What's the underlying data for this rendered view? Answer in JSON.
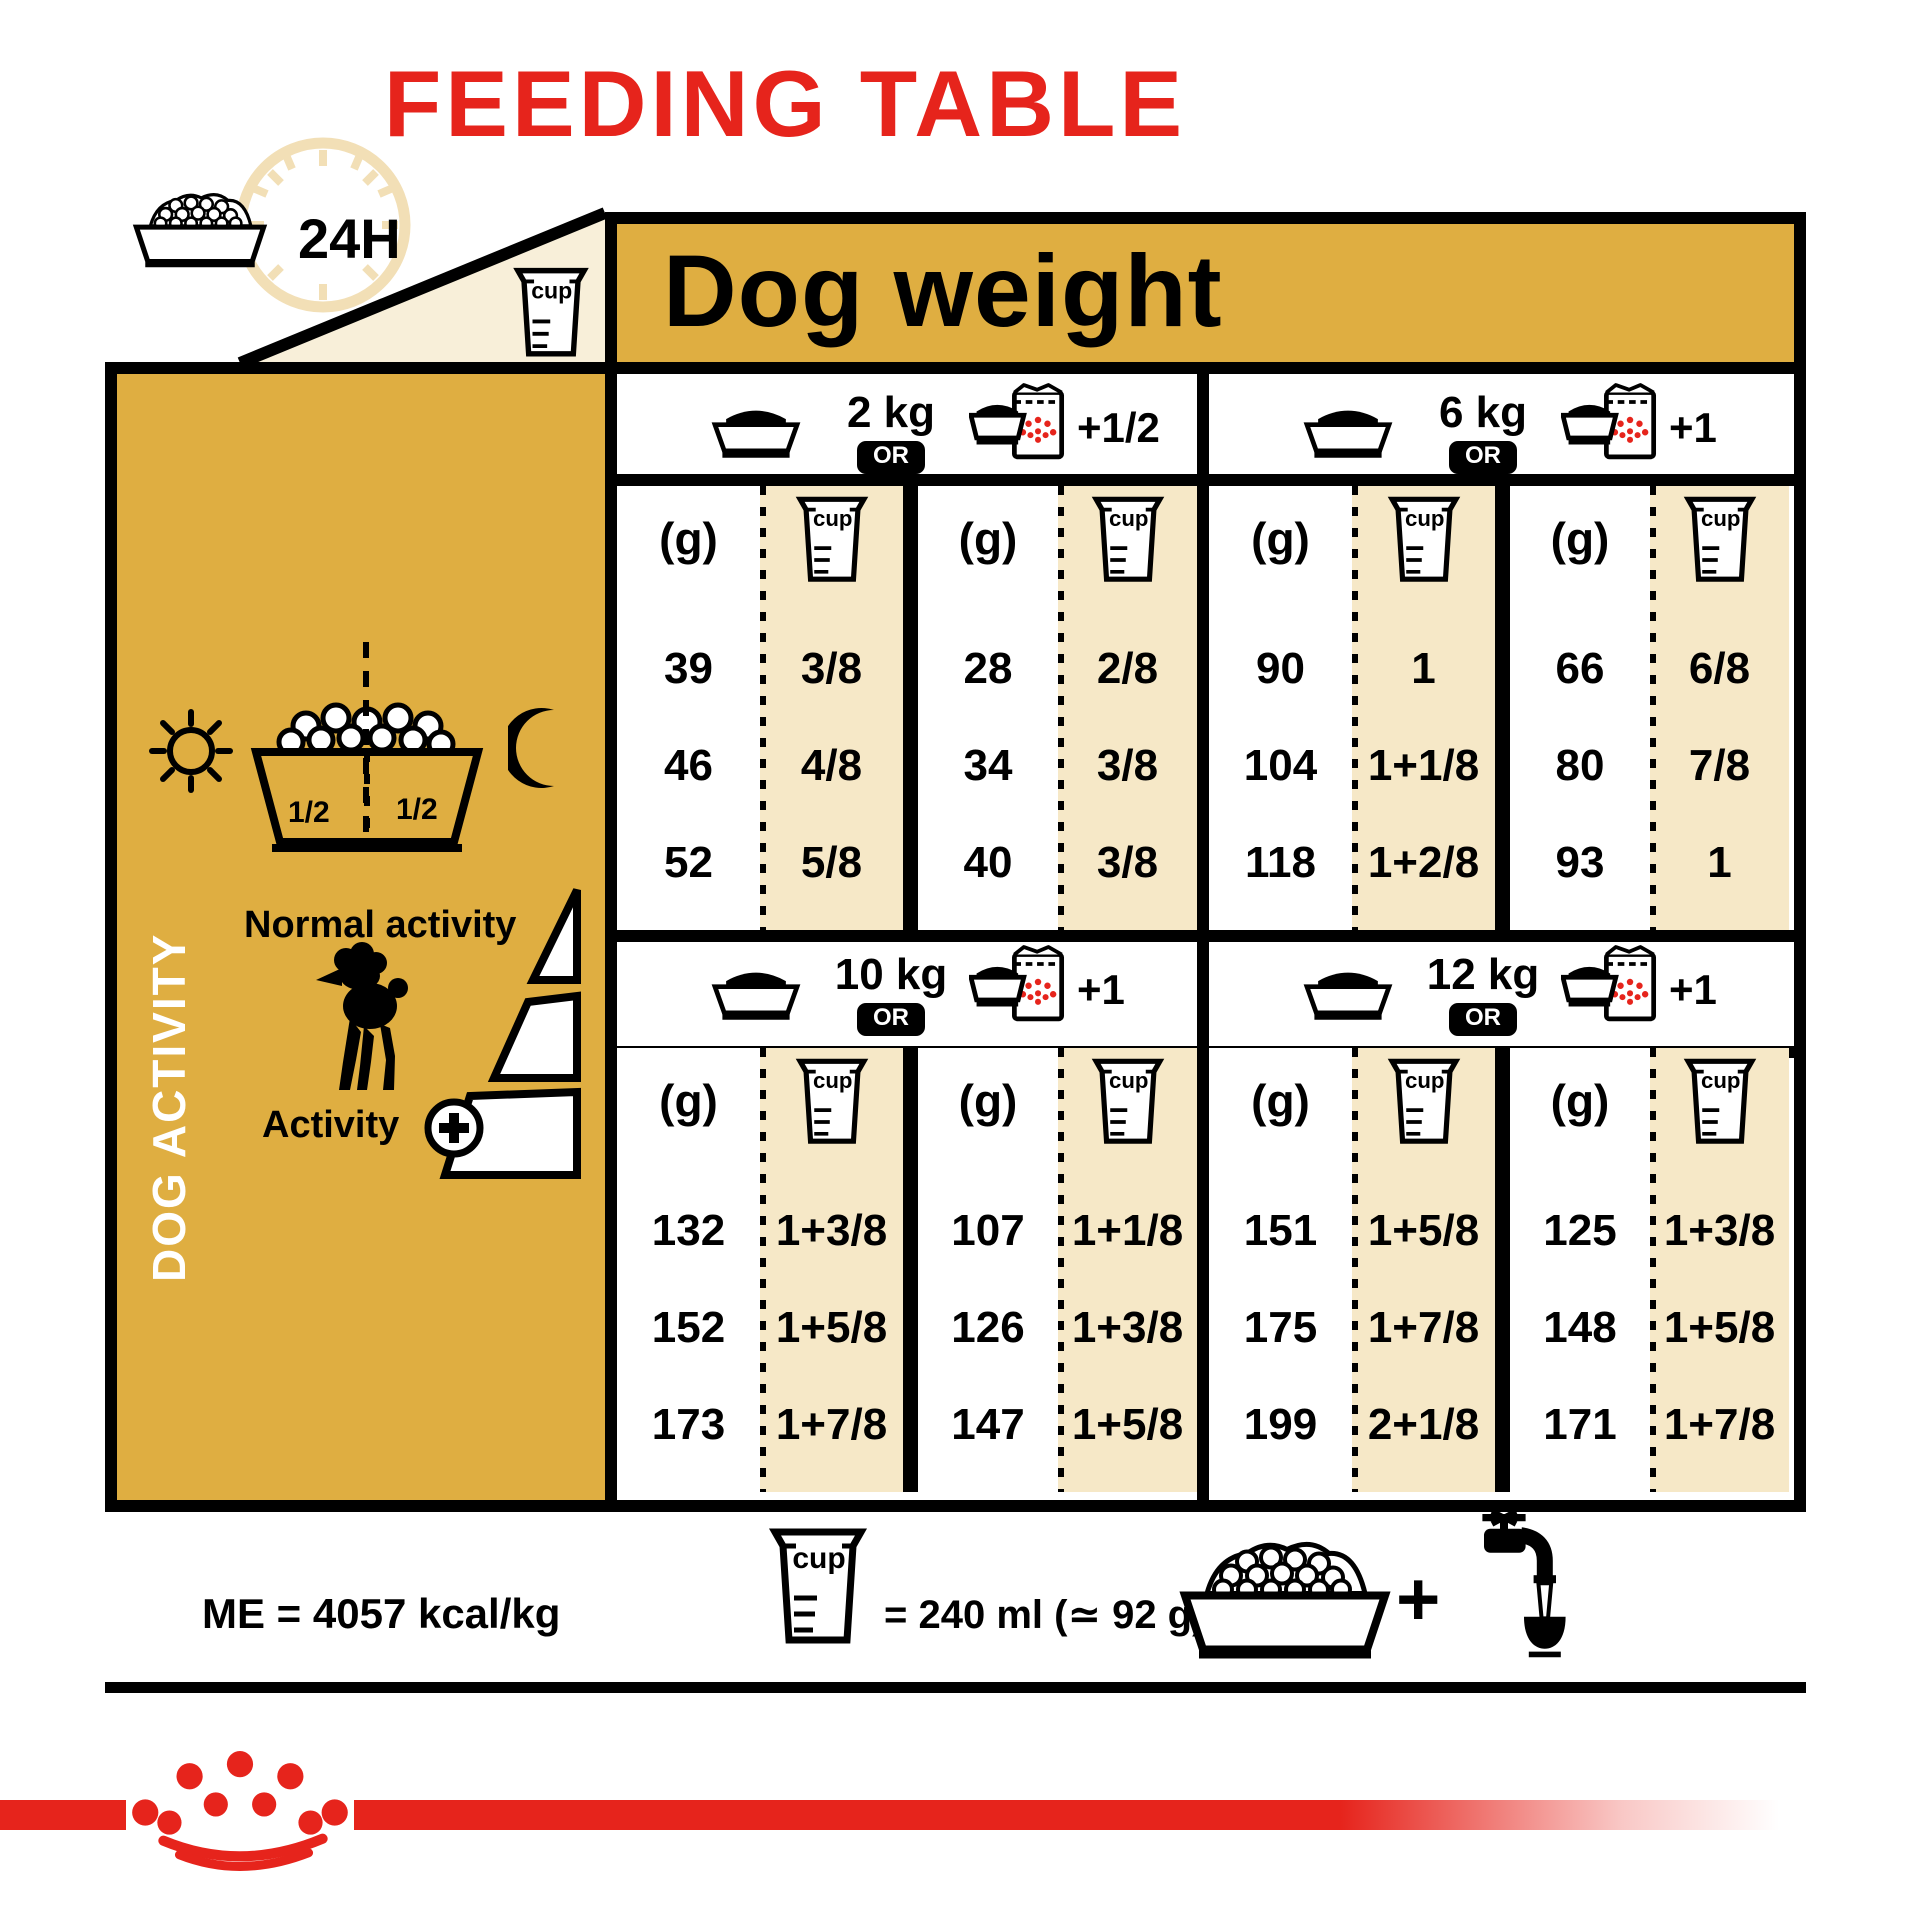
{
  "title": "FEEDING TABLE",
  "colors": {
    "gold": "#DFAE41",
    "cream_column": "#F6E8C7",
    "cream_triangle": "#F8EFD9",
    "clock_cream": "#F2DFB6",
    "red": "#E6241C",
    "black": "#000000",
    "white": "#FFFFFF"
  },
  "top": {
    "h24": "24H",
    "dog_weight": "Dog weight"
  },
  "labels": {
    "or": "OR",
    "grams": "(g)",
    "cup": "cup"
  },
  "sidebar": {
    "dog_activity": "DOG ACTIVITY",
    "half_left": "1/2",
    "half_right": "1/2",
    "normal_activity": "Normal activity",
    "activity": "Activity"
  },
  "sections": [
    {
      "weight": "2 kg",
      "extra": "+1/2",
      "rows": [
        [
          "39",
          "3/8",
          "28",
          "2/8"
        ],
        [
          "46",
          "4/8",
          "34",
          "3/8"
        ],
        [
          "52",
          "5/8",
          "40",
          "3/8"
        ]
      ]
    },
    {
      "weight": "6 kg",
      "extra": "+1",
      "rows": [
        [
          "90",
          "1",
          "66",
          "6/8"
        ],
        [
          "104",
          "1+1/8",
          "80",
          "7/8"
        ],
        [
          "118",
          "1+2/8",
          "93",
          "1"
        ]
      ]
    },
    {
      "weight": "10 kg",
      "extra": "+1",
      "rows": [
        [
          "132",
          "1+3/8",
          "107",
          "1+1/8"
        ],
        [
          "152",
          "1+5/8",
          "126",
          "1+3/8"
        ],
        [
          "173",
          "1+7/8",
          "147",
          "1+5/8"
        ]
      ]
    },
    {
      "weight": "12 kg",
      "extra": "+1",
      "rows": [
        [
          "151",
          "1+5/8",
          "125",
          "1+3/8"
        ],
        [
          "175",
          "1+7/8",
          "148",
          "1+5/8"
        ],
        [
          "199",
          "2+1/8",
          "171",
          "1+7/8"
        ]
      ]
    }
  ],
  "footer": {
    "me": "ME = 4057 kcal/kg",
    "cup_equals": "= 240 ml (≃ 92 g)",
    "plus": "+"
  }
}
